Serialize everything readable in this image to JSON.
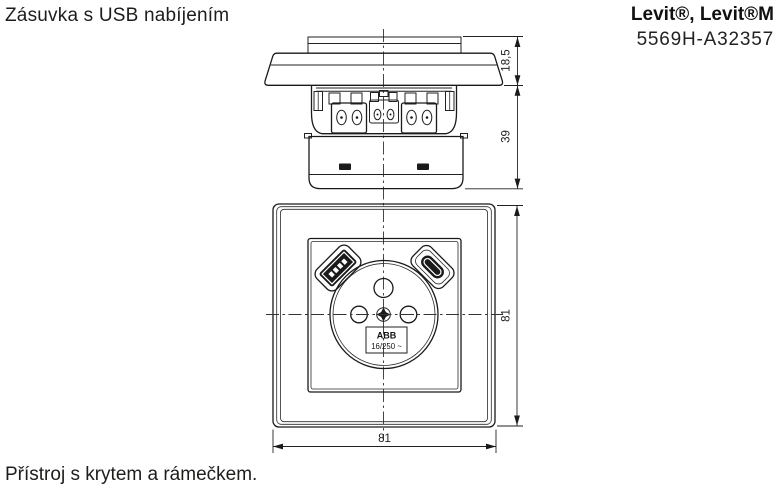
{
  "page": {
    "title": "Zásuvka s USB nabíjením",
    "brand_line": "Levit®, Levit®M",
    "product_code": "5569H-A32357",
    "caption": "Přístroj s krytem a rámečkem."
  },
  "drawing": {
    "side_view": {
      "dim_frame_height": "18,5",
      "dim_body_depth": "39"
    },
    "front_view": {
      "dim_height": "81",
      "dim_width": "81",
      "rating_label": {
        "line1": "ABB",
        "line2": "16/250 ~"
      }
    }
  },
  "colors": {
    "ink": "#1d1d1b",
    "background": "#ffffff"
  }
}
